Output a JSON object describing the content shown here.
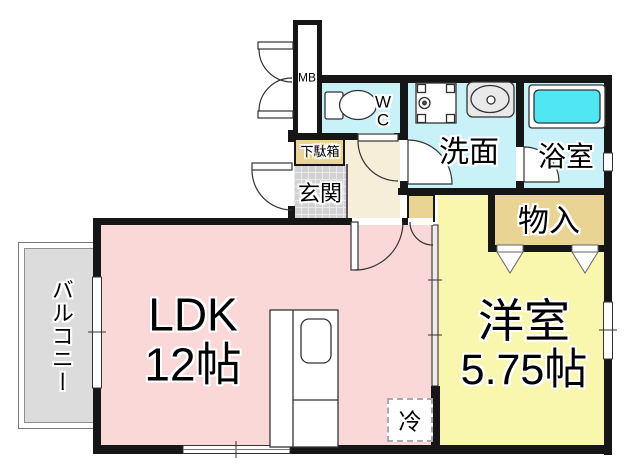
{
  "floorplan": {
    "labels": {
      "balcony": "バルコニー",
      "ldk_name": "LDK",
      "ldk_size": "12帖",
      "western_room_name": "洋室",
      "western_room_size": "5.75帖",
      "entrance": "玄関",
      "shoe_cabinet": "下駄箱",
      "toilet": "WC",
      "washroom": "洗面",
      "bathroom": "浴室",
      "storage": "物入",
      "meter_box": "MB",
      "refrigerator": "冷"
    },
    "colors": {
      "ldk_fill": "#fbd8d8",
      "western_room_fill": "#f9f6ad",
      "wet_area_fill": "#c8f2f7",
      "bathtub_fill": "#4ee6f0",
      "storage_fill": "#e9d493",
      "hallway_fill": "#f6eed9",
      "balcony_fill": "#dcdcdc",
      "entrance_tile_fill": "#d2d2d2",
      "wall": "#161616"
    },
    "fixtures": [
      "toilet",
      "washing-machine-pan",
      "sink",
      "bathtub",
      "kitchen-counter",
      "refrigerator-space",
      "meter-box"
    ]
  }
}
